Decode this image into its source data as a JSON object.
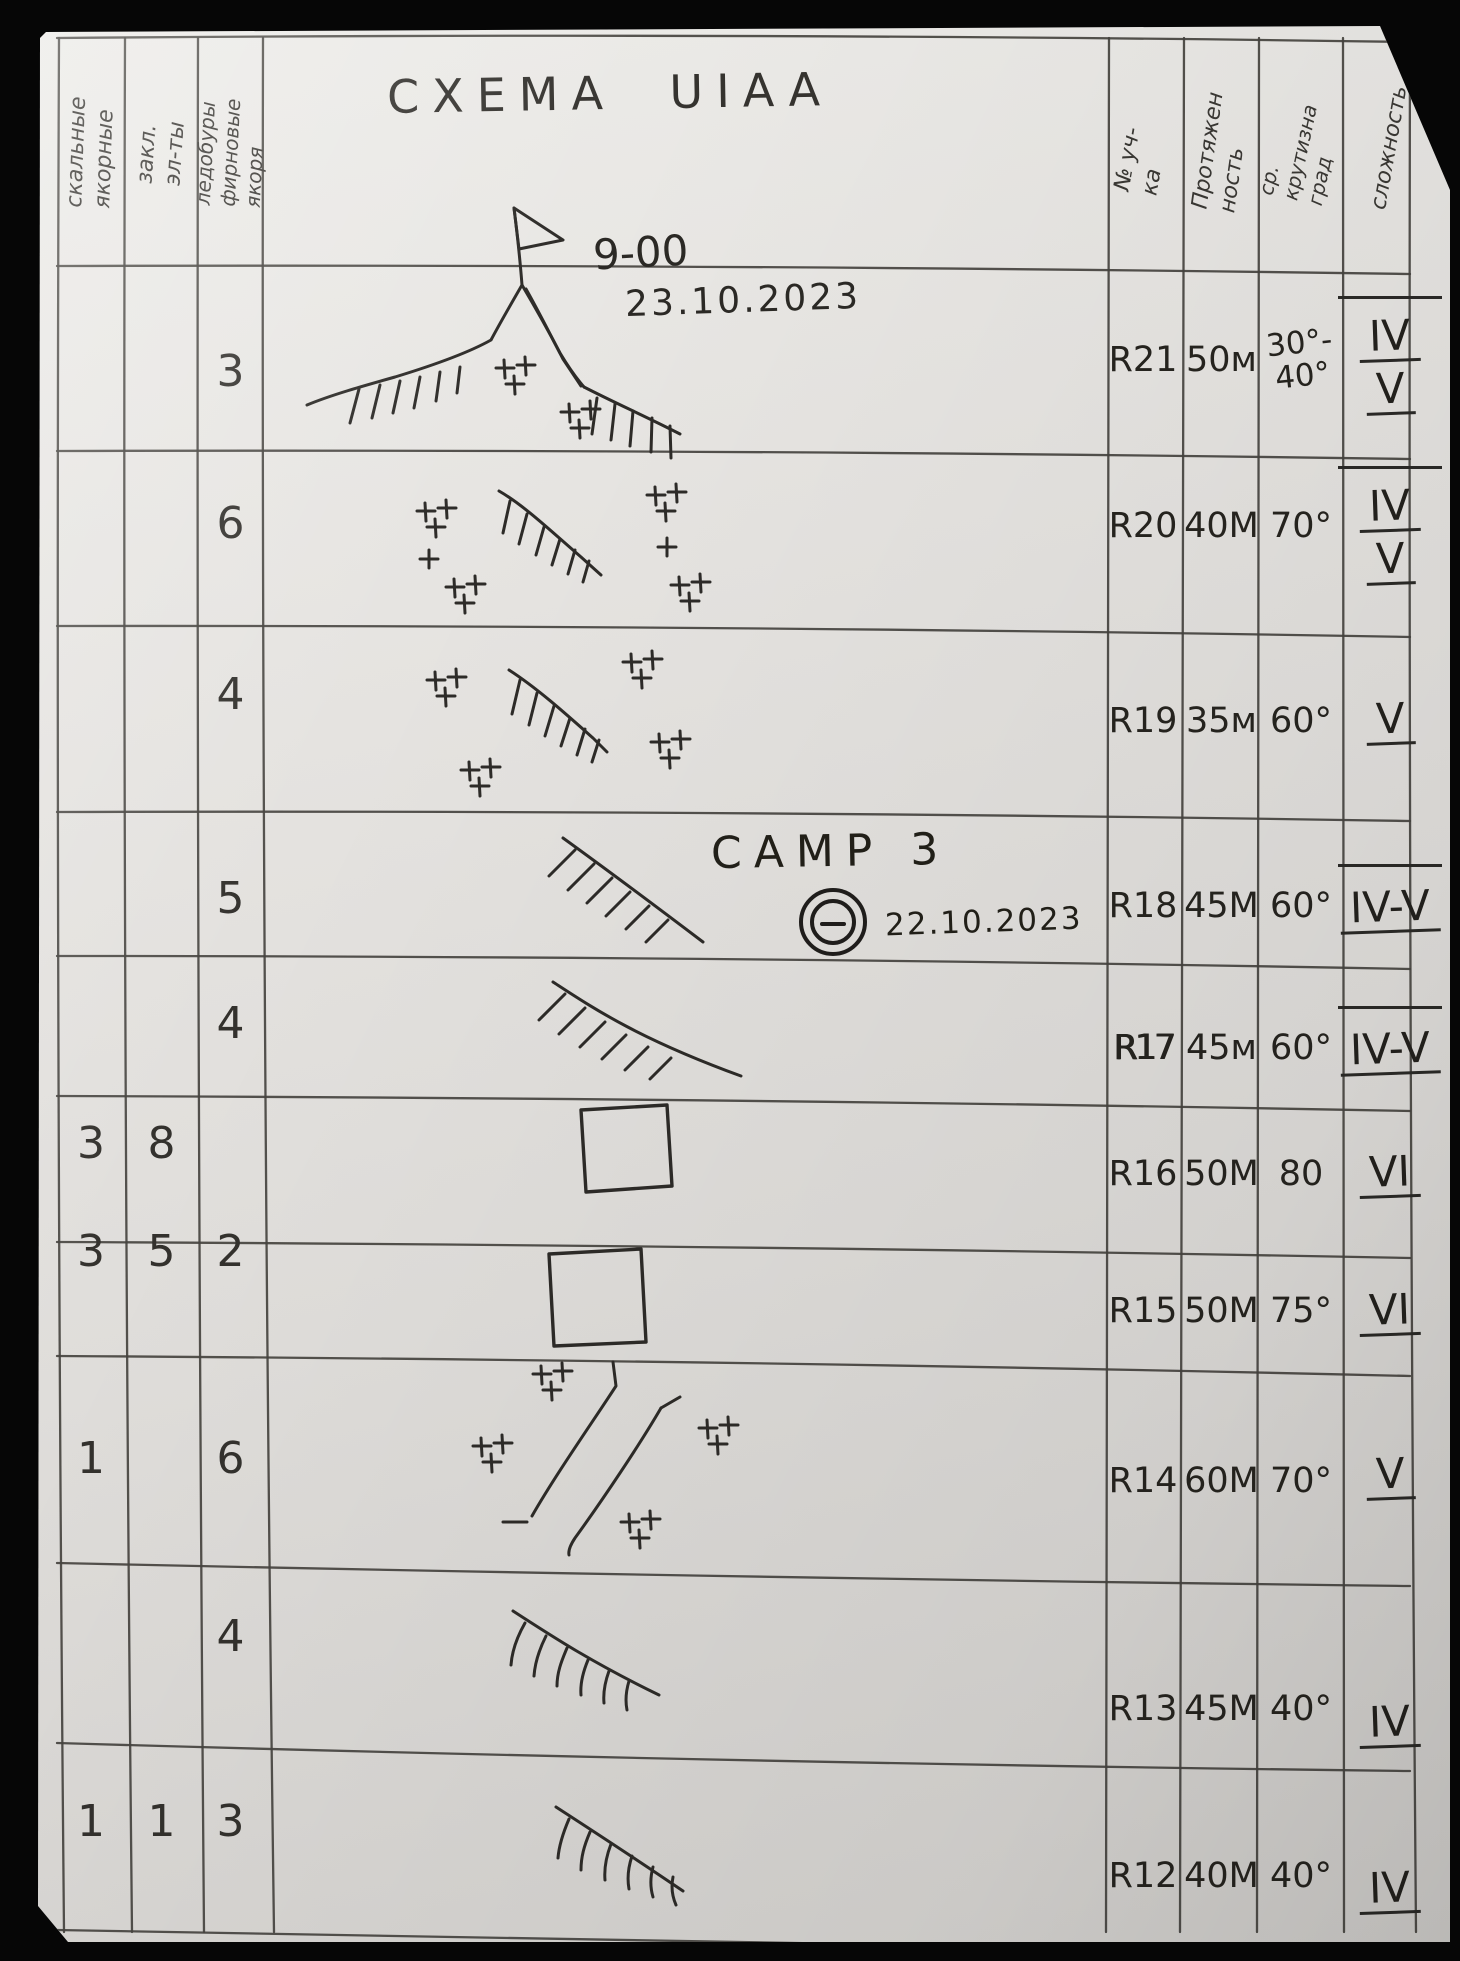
{
  "title": "CXEMA UIAA",
  "columns": {
    "rock": "скальные\nякорные",
    "nuts": "закл.\nэл-ты",
    "ice": "ледобуры\nфирновые якоря",
    "section": "№ уч-ка",
    "length": "Протяжен\nность",
    "steepness": "ср. крутизна\nград",
    "difficulty": "сложность"
  },
  "annotations": {
    "summit_time": "9-00",
    "summit_date": "23.10.2023",
    "camp": "CAMP 3",
    "camp_date": "22.10.2023"
  },
  "rows": [
    {
      "section": "R21",
      "rock": "",
      "nuts": "",
      "ice": "3",
      "length": "50м",
      "steepness": "30°-\n40°",
      "difficulty": [
        "IV",
        "V"
      ],
      "sketch": "summit with flag, hatched ridges, rock crosses"
    },
    {
      "section": "R20",
      "rock": "",
      "nuts": "",
      "ice": "6",
      "length": "40М",
      "steepness": "70°",
      "difficulty": [
        "IV",
        "V"
      ],
      "sketch": "rock crosses and hatched bergschrund line"
    },
    {
      "section": "R19",
      "rock": "",
      "nuts": "",
      "ice": "4",
      "length": "35м",
      "steepness": "60°",
      "difficulty": [
        "V"
      ],
      "sketch": "rock crosses and hatched bergschrund line"
    },
    {
      "section": "R18",
      "rock": "",
      "nuts": "",
      "ice": "5",
      "length": "45М",
      "steepness": "60°",
      "difficulty": [
        "IV-V"
      ],
      "sketch": "hatched slope, camp 3 tent symbol"
    },
    {
      "section": "R17",
      "rock": "",
      "nuts": "",
      "ice": "4",
      "length": "45м",
      "steepness": "60°",
      "difficulty": [
        "IV-V"
      ],
      "sketch": "hatched slope"
    },
    {
      "section": "R16",
      "rock": "3",
      "nuts": "8",
      "ice": "",
      "length": "50М",
      "steepness": "80",
      "difficulty": [
        "VI"
      ],
      "sketch": "rock block square"
    },
    {
      "section": "R15",
      "rock": "3",
      "nuts": "5",
      "ice": "2",
      "length": "50М",
      "steepness": "75°",
      "difficulty": [
        "VI"
      ],
      "sketch": "rock block square"
    },
    {
      "section": "R14",
      "rock": "1",
      "nuts": "",
      "ice": "6",
      "length": "60М",
      "steepness": "70°",
      "difficulty": [
        "V"
      ],
      "sketch": "couloir lines with rock crosses"
    },
    {
      "section": "R13",
      "rock": "",
      "nuts": "",
      "ice": "4",
      "length": "45М",
      "steepness": "40°",
      "difficulty": [
        "IV"
      ],
      "sketch": "hatched slope"
    },
    {
      "section": "R12",
      "rock": "1",
      "nuts": "1",
      "ice": "3",
      "length": "40М",
      "steepness": "40°",
      "difficulty": [
        "IV"
      ],
      "sketch": "hatched slope"
    }
  ]
}
